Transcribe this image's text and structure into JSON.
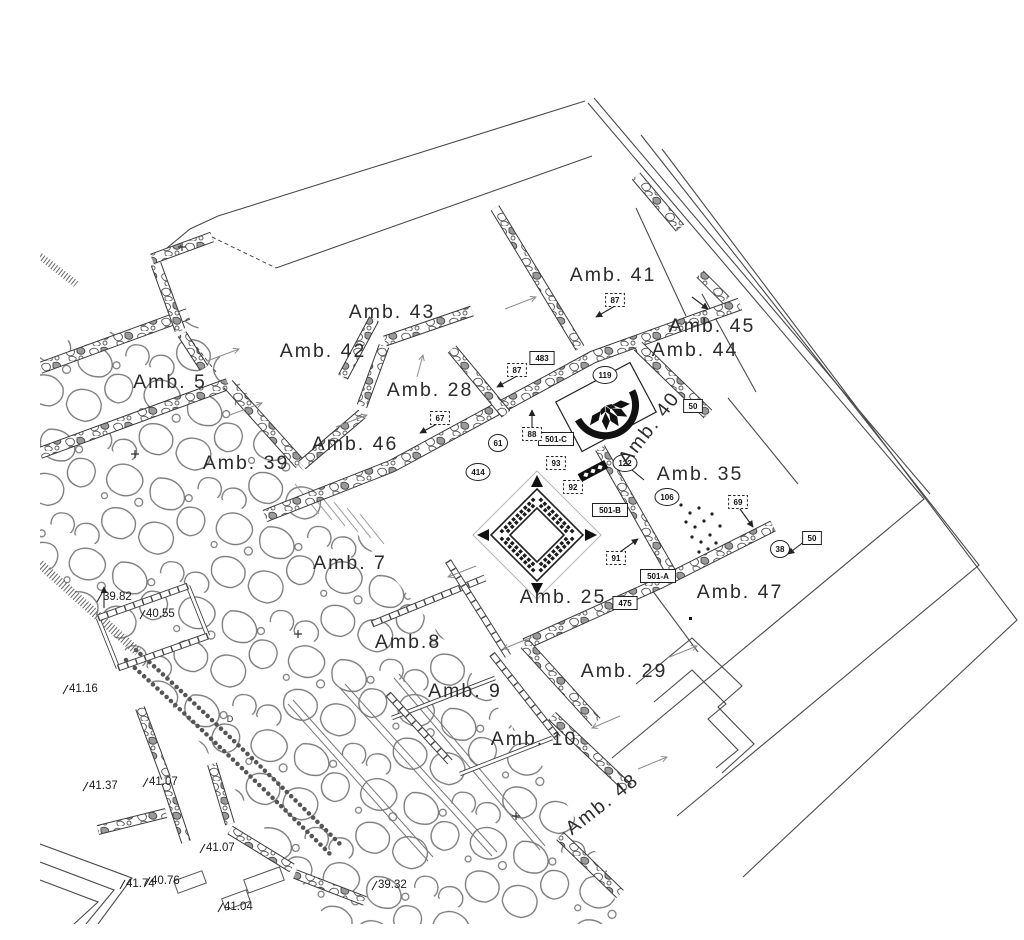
{
  "meta": {
    "title": "Archaeological excavation plan",
    "background": "#ffffff",
    "ink": "#2b2b2b",
    "wall_ink": "#3a3a3a",
    "light_ink": "#8c8c8c",
    "stone_ink": "#777777",
    "mosaic_color": "#111111"
  },
  "rooms": [
    {
      "label": "Amb. 5",
      "x": 130,
      "y": 372,
      "rot": 0
    },
    {
      "label": "Amb. 42",
      "x": 283,
      "y": 341,
      "rot": 0
    },
    {
      "label": "Amb. 43",
      "x": 352,
      "y": 302,
      "rot": 0
    },
    {
      "label": "Amb. 41",
      "x": 573,
      "y": 265,
      "rot": 0
    },
    {
      "label": "Amb. 45",
      "x": 672,
      "y": 316,
      "rot": 0
    },
    {
      "label": "Amb. 44",
      "x": 655,
      "y": 340,
      "rot": 0
    },
    {
      "label": "Amb. 28",
      "x": 390,
      "y": 380,
      "rot": 0
    },
    {
      "label": "Amb. 46",
      "x": 315,
      "y": 434,
      "rot": 0
    },
    {
      "label": "Amb. 39",
      "x": 206,
      "y": 453,
      "rot": 0
    },
    {
      "label": "Amb. 40",
      "x": 614,
      "y": 416,
      "rot": -52
    },
    {
      "label": "Amb. 35",
      "x": 660,
      "y": 464,
      "rot": 0
    },
    {
      "label": "Amb. 7",
      "x": 310,
      "y": 553,
      "rot": 0
    },
    {
      "label": "Amb. 25",
      "x": 523,
      "y": 587,
      "rot": 0
    },
    {
      "label": "Amb. 47",
      "x": 700,
      "y": 582,
      "rot": 0
    },
    {
      "label": "Amb.8",
      "x": 368,
      "y": 632,
      "rot": 0
    },
    {
      "label": "Amb. 9",
      "x": 425,
      "y": 681,
      "rot": 0
    },
    {
      "label": "Amb. 10",
      "x": 494,
      "y": 729,
      "rot": 0
    },
    {
      "label": "Amb. 29",
      "x": 584,
      "y": 661,
      "rot": 0
    },
    {
      "label": "Amb. 48",
      "x": 566,
      "y": 793,
      "rot": -38
    }
  ],
  "elevations": [
    {
      "value": "39.82",
      "x": 62,
      "y": 584
    },
    {
      "value": "40.55",
      "x": 105,
      "y": 601
    },
    {
      "value": "41.16",
      "x": 28,
      "y": 676
    },
    {
      "value": "41.37",
      "x": 48,
      "y": 773
    },
    {
      "value": "41.07",
      "x": 108,
      "y": 769
    },
    {
      "value": "41.07",
      "x": 165,
      "y": 835
    },
    {
      "value": "41.74",
      "x": 85,
      "y": 871
    },
    {
      "value": "40.76",
      "x": 110,
      "y": 868
    },
    {
      "value": "41.04",
      "x": 183,
      "y": 894
    },
    {
      "value": "39.32",
      "x": 337,
      "y": 872
    }
  ],
  "find_tags": {
    "circled": [
      {
        "t": "61",
        "x": 458,
        "y": 427
      },
      {
        "t": "414",
        "x": 438,
        "y": 456
      },
      {
        "t": "119",
        "x": 565,
        "y": 359
      },
      {
        "t": "122",
        "x": 585,
        "y": 447
      },
      {
        "t": "106",
        "x": 627,
        "y": 481
      },
      {
        "t": "38",
        "x": 740,
        "y": 533
      }
    ],
    "boxed": [
      {
        "t": "483",
        "x": 502,
        "y": 342
      },
      {
        "t": "50",
        "x": 653,
        "y": 390
      },
      {
        "t": "50",
        "x": 772,
        "y": 522
      },
      {
        "t": "501-C",
        "x": 516,
        "y": 423
      },
      {
        "t": "501-B",
        "x": 570,
        "y": 494
      },
      {
        "t": "501-A",
        "x": 618,
        "y": 560
      },
      {
        "t": "475",
        "x": 585,
        "y": 587
      }
    ],
    "dashed": [
      {
        "t": "87",
        "x": 477,
        "y": 354
      },
      {
        "t": "87",
        "x": 575,
        "y": 284
      },
      {
        "t": "67",
        "x": 400,
        "y": 402
      },
      {
        "t": "88",
        "x": 492,
        "y": 418
      },
      {
        "t": "93",
        "x": 516,
        "y": 447
      },
      {
        "t": "92",
        "x": 533,
        "y": 471
      },
      {
        "t": "91",
        "x": 576,
        "y": 542
      },
      {
        "t": "69",
        "x": 698,
        "y": 486
      }
    ]
  },
  "misc_labels": [
    {
      "text": "D",
      "x": 190,
      "y": 706,
      "size": 9
    }
  ]
}
